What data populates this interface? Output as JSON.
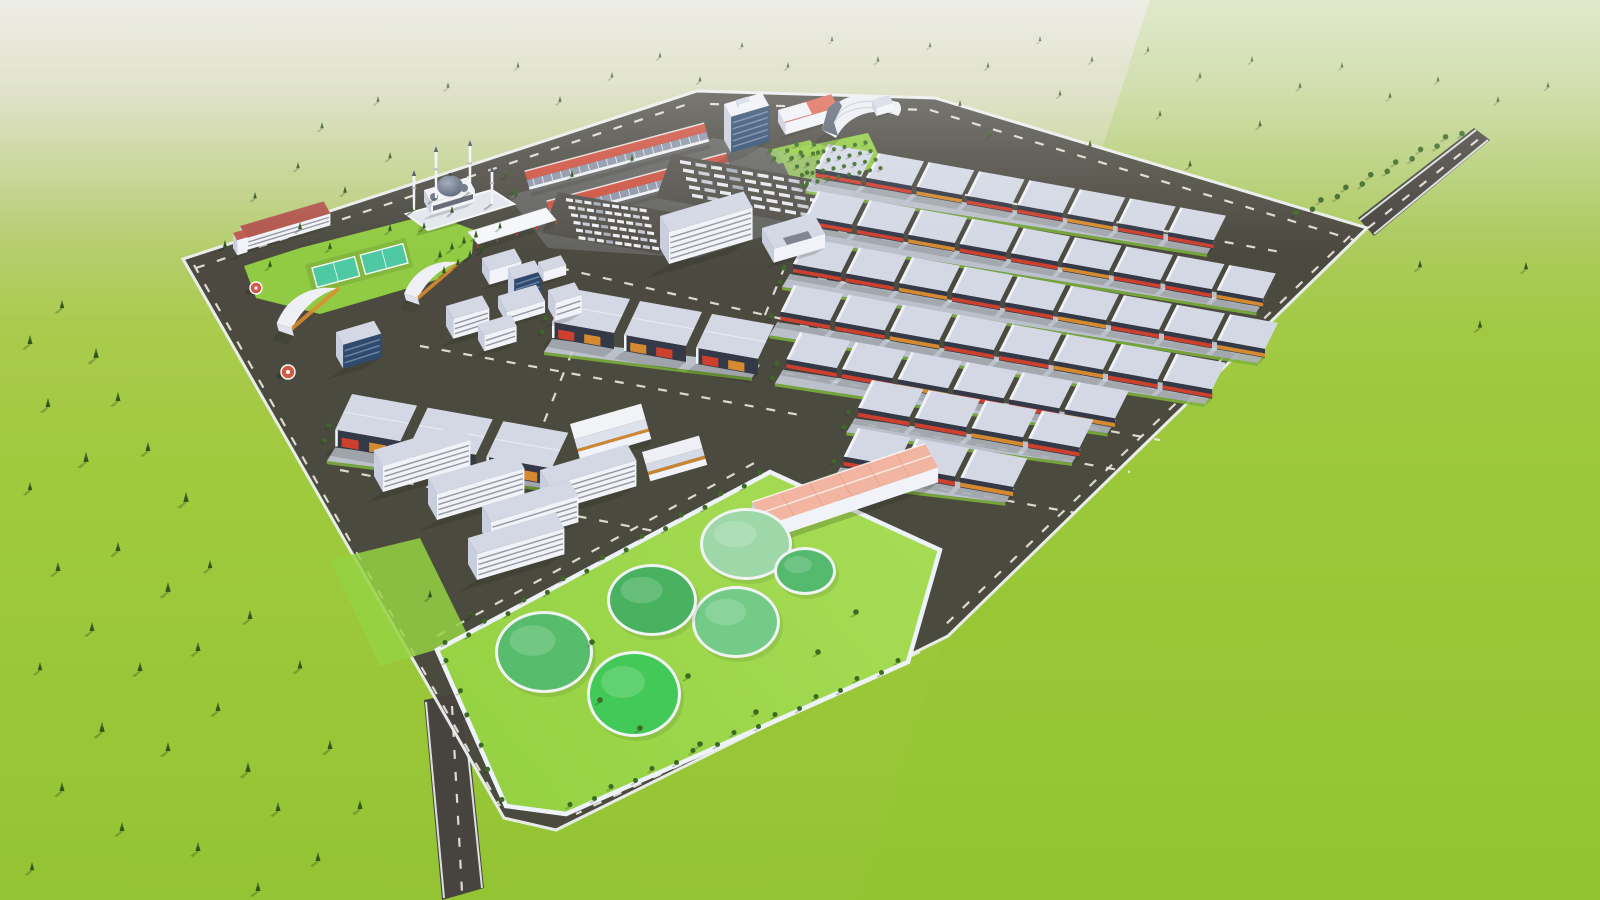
{
  "scene": {
    "type": "3d-aerial-architectural-render",
    "subject": "industrial-park-master-plan",
    "palette": {
      "sky_top": "#e0e0d3",
      "sky_mid": "#d6d9b8",
      "grass_haze": "#bccf7e",
      "grass_light": "#aacb4e",
      "grass": "#a0ca3e",
      "grass_deep": "#93c433",
      "grass_right": "#8fc42e",
      "lawn": "#95d243",
      "lawn_bright": "#a6dc55",
      "asphalt": "#47443f",
      "lot_gray": "#55524d",
      "road_line": "#eceae0",
      "curb": "#edeff1",
      "apron": "#c8ced9",
      "verge": "#7bb43a",
      "wall_white": "#f1f3f8",
      "wall_shade": "#c8cedd",
      "roof_top": "#d3d8e4",
      "roof_ridge": "#f3f5f9",
      "facade_dark": "#343947",
      "window_dark": "#3a4050",
      "accent_red": "#d6402d",
      "accent_orange": "#de8e2f",
      "strip_red": "#cd5240",
      "salmon": "#f2b5a2",
      "salmon_dark": "#e09a86",
      "coral_roof": "#dd6652",
      "admin_roof": "#b2564c",
      "glass_blue": "#3f6fd0",
      "glass_dark": "#2e4a6e",
      "court_teal": "#4ec9a2",
      "pond_rim": "#f0f4f4",
      "tree_dark": "#30551d",
      "tree_mid": "#47742c",
      "bush": "#3c6a24",
      "hangar_roof": "#eceef4",
      "dome_light": "#9aa6b8",
      "dome_dark": "#4b5462",
      "shadow": "#1d2416"
    },
    "counts": {
      "treatment_ponds": 6,
      "mosque_minarets": 4,
      "commercial_strips": 2,
      "sports_courts": 2,
      "warehouse_rows_right": 7,
      "factory_rows_center": 2,
      "office_slabs": 5
    }
  },
  "layout": {
    "warehouse_rows": [
      {
        "x": 828,
        "y": 144,
        "n": 8,
        "s": 0.95
      },
      {
        "x": 818,
        "y": 191,
        "n": 9,
        "s": 0.97
      },
      {
        "x": 806,
        "y": 238,
        "n": 9,
        "s": 1.0
      },
      {
        "x": 794,
        "y": 285,
        "n": 8,
        "s": 1.03
      },
      {
        "x": 800,
        "y": 332,
        "n": 6,
        "s": 1.05
      },
      {
        "x": 872,
        "y": 380,
        "n": 4,
        "s": 1.07
      },
      {
        "x": 858,
        "y": 428,
        "n": 3,
        "s": 1.1
      }
    ],
    "factory_rows": [
      {
        "x": 568,
        "y": 288,
        "n": 3,
        "s": 1.0
      },
      {
        "x": 352,
        "y": 394,
        "n": 3,
        "s": 1.05
      }
    ],
    "office_slabs": [
      [
        374,
        450
      ],
      [
        540,
        470
      ],
      [
        428,
        478
      ],
      [
        482,
        506
      ],
      [
        468,
        538
      ]
    ],
    "ponds": [
      {
        "cx": 746,
        "cy": 544,
        "rx": 43,
        "ry": 33,
        "c": "#9ed8a8"
      },
      {
        "cx": 805,
        "cy": 571,
        "rx": 28,
        "ry": 21,
        "c": "#55b96e"
      },
      {
        "cx": 736,
        "cy": 622,
        "rx": 41,
        "ry": 33,
        "c": "#74cb88"
      },
      {
        "cx": 652,
        "cy": 600,
        "rx": 42,
        "ry": 33,
        "c": "#49b260"
      },
      {
        "cx": 544,
        "cy": 652,
        "rx": 46,
        "ry": 38,
        "c": "#57bd6c"
      },
      {
        "cx": 634,
        "cy": 694,
        "rx": 44,
        "ry": 40,
        "c": "#43c957"
      }
    ],
    "cars": {
      "x0": 566,
      "y0": 198,
      "rows": 6,
      "cols": 9,
      "dx": 9.2,
      "dy": 7.6,
      "rx": 2.5,
      "slope": 0.14,
      "w": 7,
      "h": 3.2
    },
    "trucks": {
      "x0": 680,
      "y0": 160,
      "rows": 5,
      "cols": 9,
      "dx": 15.5,
      "dy": 8.4,
      "rx": 3,
      "slope": 0.17,
      "w": 11,
      "h": 3.4
    },
    "orchard": {
      "x0": 792,
      "y0": 158,
      "rows": 4,
      "cols": 8,
      "cdx": 10.5,
      "cdy": -2.2,
      "rdx": 5,
      "rdy": 8.5,
      "s": 0.75
    },
    "shrub_segments": [
      {
        "x1": 1298,
        "y1": 214,
        "x2": 1460,
        "y2": 132,
        "n": 14,
        "s": 1.0
      },
      {
        "x1": 447,
        "y1": 644,
        "x2": 762,
        "y2": 474,
        "n": 17,
        "s": 0.9
      },
      {
        "x1": 572,
        "y1": 806,
        "x2": 900,
        "y2": 662,
        "n": 17,
        "s": 0.9
      },
      {
        "x1": 448,
        "y1": 662,
        "x2": 500,
        "y2": 798,
        "n": 6,
        "s": 0.9
      },
      {
        "x1": 772,
        "y1": 152,
        "x2": 812,
        "y2": 143,
        "n": 4,
        "s": 0.8
      },
      {
        "x1": 776,
        "y1": 160,
        "x2": 816,
        "y2": 151,
        "n": 4,
        "s": 0.8
      }
    ],
    "parcel_bushes": [
      [
        600,
        700
      ],
      [
        640,
        728
      ],
      [
        700,
        744
      ],
      [
        756,
        712
      ],
      [
        818,
        652
      ],
      [
        856,
        612
      ],
      [
        592,
        642
      ],
      [
        688,
        676
      ]
    ],
    "trees": [
      [
        30,
        335,
        1
      ],
      [
        62,
        300,
        0.9
      ],
      [
        96,
        348,
        1.1
      ],
      [
        48,
        398,
        1
      ],
      [
        118,
        392,
        1
      ],
      [
        86,
        452,
        1.1
      ],
      [
        30,
        482,
        0.9
      ],
      [
        148,
        442,
        1
      ],
      [
        186,
        492,
        1.1
      ],
      [
        58,
        562,
        1
      ],
      [
        118,
        542,
        1
      ],
      [
        168,
        582,
        1.1
      ],
      [
        92,
        622,
        1
      ],
      [
        40,
        662,
        0.9
      ],
      [
        140,
        662,
        1
      ],
      [
        198,
        642,
        1
      ],
      [
        102,
        722,
        1.1
      ],
      [
        168,
        742,
        1
      ],
      [
        62,
        782,
        1
      ],
      [
        218,
        702,
        1
      ],
      [
        248,
        762,
        1.1
      ],
      [
        122,
        822,
        1
      ],
      [
        198,
        842,
        1
      ],
      [
        278,
        802,
        1
      ],
      [
        318,
        852,
        1
      ],
      [
        32,
        862,
        0.9
      ],
      [
        258,
        882,
        1
      ],
      [
        210,
        560,
        0.9
      ],
      [
        250,
        610,
        1
      ],
      [
        300,
        660,
        0.95
      ],
      [
        330,
        740,
        1
      ],
      [
        360,
        800,
        1
      ],
      [
        255,
        192,
        0.7
      ],
      [
        298,
        162,
        0.7
      ],
      [
        345,
        186,
        0.75
      ],
      [
        390,
        152,
        0.7
      ],
      [
        300,
        222,
        0.8
      ],
      [
        225,
        240,
        0.8
      ],
      [
        322,
        122,
        0.7
      ],
      [
        378,
        96,
        0.65
      ],
      [
        448,
        82,
        0.65
      ],
      [
        518,
        62,
        0.6
      ],
      [
        560,
        96,
        0.65
      ],
      [
        612,
        72,
        0.6
      ],
      [
        660,
        52,
        0.6
      ],
      [
        700,
        76,
        0.6
      ],
      [
        742,
        42,
        0.55
      ],
      [
        788,
        62,
        0.6
      ],
      [
        832,
        36,
        0.55
      ],
      [
        878,
        56,
        0.6
      ],
      [
        930,
        42,
        0.55
      ],
      [
        988,
        62,
        0.6
      ],
      [
        1040,
        36,
        0.55
      ],
      [
        1092,
        56,
        0.6
      ],
      [
        1148,
        46,
        0.6
      ],
      [
        1200,
        72,
        0.65
      ],
      [
        1252,
        56,
        0.6
      ],
      [
        1300,
        82,
        0.65
      ],
      [
        1342,
        62,
        0.6
      ],
      [
        1390,
        92,
        0.65
      ],
      [
        1438,
        76,
        0.6
      ],
      [
        1498,
        96,
        0.65
      ],
      [
        1548,
        82,
        0.6
      ],
      [
        960,
        100,
        0.65
      ],
      [
        1060,
        90,
        0.6
      ],
      [
        1160,
        110,
        0.65
      ],
      [
        1260,
        120,
        0.7
      ],
      [
        1090,
        140,
        0.7
      ],
      [
        1190,
        160,
        0.7
      ],
      [
        990,
        130,
        0.65
      ],
      [
        1420,
        260,
        0.8
      ],
      [
        1480,
        320,
        0.85
      ],
      [
        1526,
        262,
        0.8
      ],
      [
        270,
        260,
        0.75
      ],
      [
        330,
        242,
        0.75
      ],
      [
        390,
        224,
        0.75
      ],
      [
        452,
        206,
        0.75
      ],
      [
        512,
        188,
        0.75
      ],
      [
        572,
        170,
        0.75
      ],
      [
        632,
        154,
        0.75
      ],
      [
        440,
        250,
        0.8
      ],
      [
        452,
        242,
        0.8
      ],
      [
        464,
        236,
        0.8
      ],
      [
        476,
        230,
        0.8
      ],
      [
        444,
        266,
        0.8
      ],
      [
        458,
        258,
        0.8
      ],
      [
        470,
        250,
        0.8
      ],
      [
        482,
        244,
        0.8
      ],
      [
        412,
        205,
        0.7
      ],
      [
        424,
        222,
        0.7
      ],
      [
        506,
        170,
        0.7
      ],
      [
        516,
        190,
        0.7
      ],
      [
        500,
        222,
        0.7
      ],
      [
        470,
        610,
        0.8
      ],
      [
        430,
        590,
        0.8
      ]
    ]
  }
}
